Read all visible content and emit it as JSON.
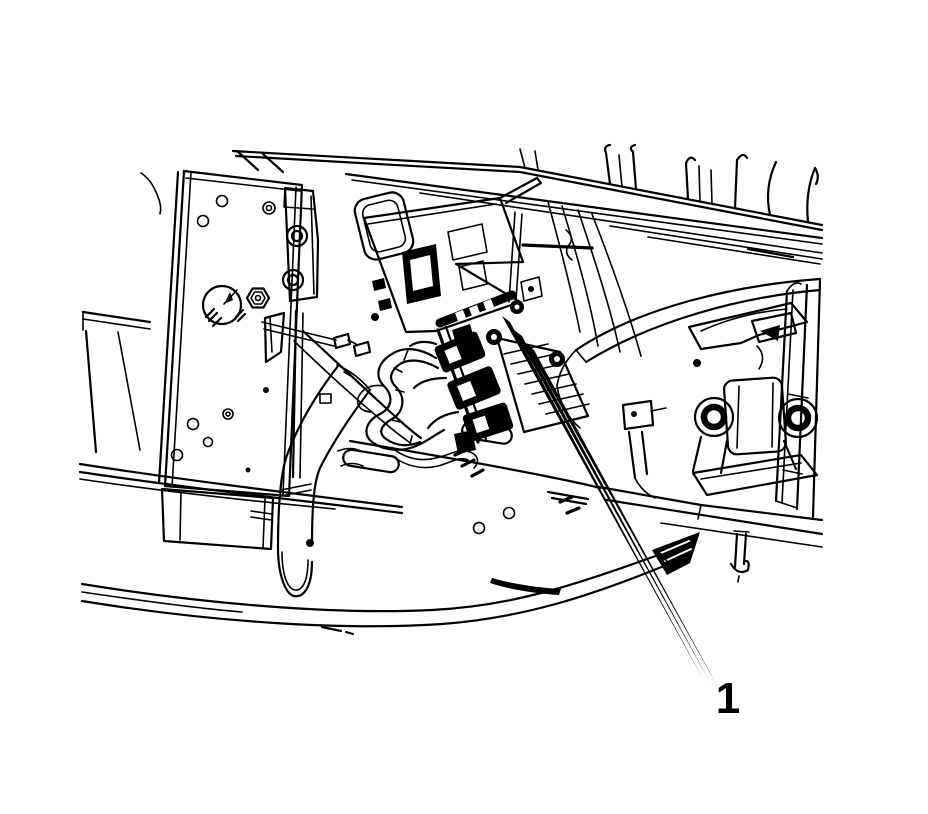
{
  "illustration": {
    "background_color": "#ffffff",
    "line_color": "#000000",
    "callouts": [
      {
        "label": "1",
        "leader_lines": 3,
        "target": "electrical-connectors",
        "label_x": 728,
        "label_y": 713
      }
    ]
  }
}
